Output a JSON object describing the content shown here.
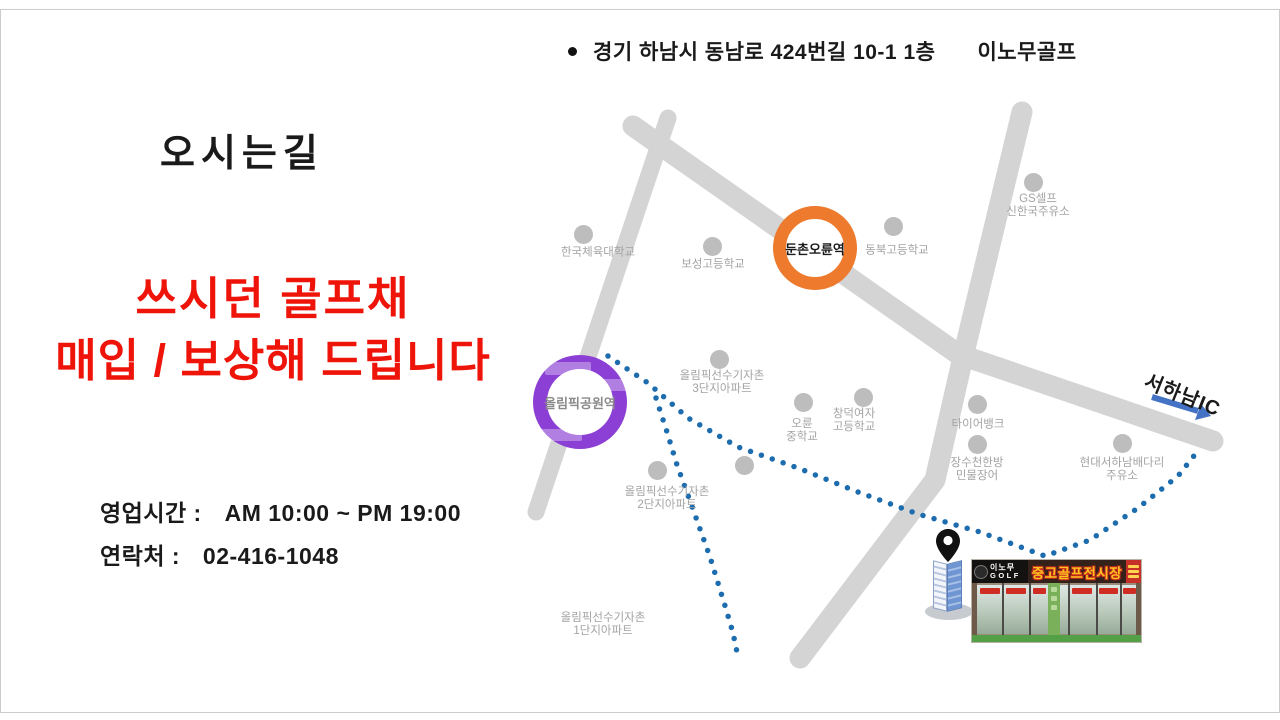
{
  "address": {
    "text": "경기 하남시 동남로 424번길 10-1 1층",
    "brand": "이노무골프"
  },
  "title": "오시는길",
  "promo": {
    "line1": "쓰시던 골프채",
    "line2": "매입 / 보상해 드립니다",
    "color": "#ee1409"
  },
  "info": {
    "hours_label": "영업시간 :",
    "hours_value": "AM 10:00 ~ PM 19:00",
    "phone_label": "연락처 :",
    "phone_value": "02-416-1048"
  },
  "map": {
    "road_color": "#d4d4d4",
    "route_color": "#1d6cae",
    "poi_dot_color": "#bdbdbd",
    "stations": [
      {
        "name": "둔촌오륜역",
        "ring_color": "#ed7a2d",
        "label_color": "#1a1a1a",
        "cx": 815,
        "cy": 248,
        "d": 84,
        "ring": 13
      },
      {
        "name": "올림픽공원역",
        "ring_color": "#8b3fd4",
        "label_color": "#8a8a8a",
        "cx": 580,
        "cy": 402,
        "d": 94,
        "ring": 14
      }
    ],
    "pois": [
      {
        "lines": [
          "한국체육대학교"
        ],
        "dot": [
          583,
          234
        ],
        "anchor": [
          598,
          253
        ]
      },
      {
        "lines": [
          "보성고등학교"
        ],
        "dot": [
          712,
          246
        ],
        "anchor": [
          713,
          265
        ]
      },
      {
        "lines": [
          "동북고등학교"
        ],
        "dot": [
          893,
          226
        ],
        "anchor": [
          897,
          251
        ]
      },
      {
        "lines": [
          "GS셀프",
          "신한국주유소"
        ],
        "dot": [
          1033,
          182
        ],
        "anchor": [
          1038,
          206
        ]
      },
      {
        "lines": [
          "올림픽선수기자촌",
          "3단지아파트"
        ],
        "dot": [
          719,
          359
        ],
        "anchor": [
          722,
          383
        ]
      },
      {
        "lines": [
          "오륜",
          "중학교"
        ],
        "dot": [
          803,
          402
        ],
        "anchor": [
          802,
          431
        ]
      },
      {
        "lines": [
          "창덕여자",
          "고등학교"
        ],
        "dot": [
          863,
          397
        ],
        "anchor": [
          854,
          421
        ]
      },
      {
        "lines": [
          "타이어뱅크"
        ],
        "dot": [
          977,
          404
        ],
        "anchor": [
          978,
          425
        ]
      },
      {
        "lines": [
          "장수천한방",
          "민물장어"
        ],
        "dot": [
          977,
          444
        ],
        "anchor": [
          977,
          470
        ]
      },
      {
        "lines": [
          "현대서하남배다리",
          "주유소"
        ],
        "dot": [
          1122,
          443
        ],
        "anchor": [
          1122,
          470
        ]
      },
      {
        "lines": [
          "올림픽선수기자촌",
          "2단지아파트"
        ],
        "dot": [
          657,
          470
        ],
        "anchor": [
          667,
          499
        ]
      },
      {
        "lines": [],
        "dot": [
          744,
          465
        ],
        "anchor": null
      },
      {
        "lines": [
          "올림픽선수기자촌",
          "1단지아파트"
        ],
        "dot": null,
        "anchor": [
          603,
          625
        ]
      }
    ],
    "highway": {
      "label": "서하남IC",
      "arrow_color": "#4472c4"
    }
  },
  "shop": {
    "pin_color": "#111111",
    "sign_brand_line1": "이노무",
    "sign_brand_line2": "GOLF",
    "sign_main": "중고골프전시장"
  }
}
